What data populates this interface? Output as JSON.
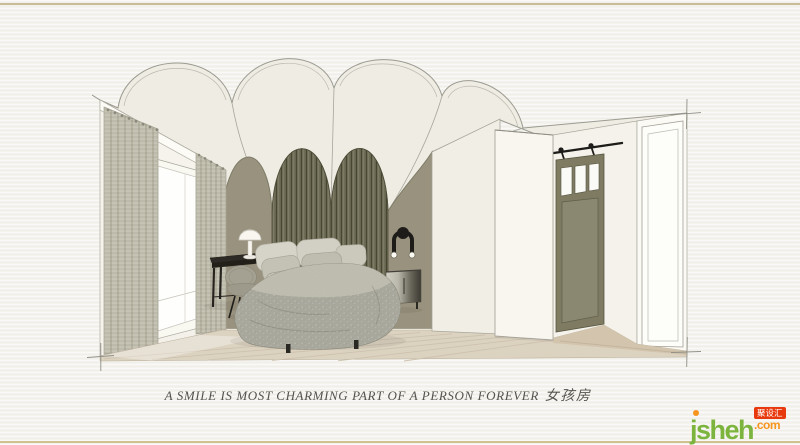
{
  "caption": {
    "text_en": "A SMILE IS MOST CHARMING PART OF A PERSON FOREVER",
    "text_zh": "女孩房"
  },
  "watermark": {
    "site": "jsheh.com",
    "brand": "jsheh",
    "tld": ".com",
    "badge_text": "聚设汇"
  },
  "palette": {
    "paper": "#f3f2ed",
    "border_gold": "#c9bd97",
    "ceiling_cream": "#efece3",
    "line_gray": "#9b9b91",
    "wall_olive": "#99927e",
    "slat_olive": "#6f6d57",
    "slat_shadow": "#474631",
    "wall_white": "#f5f3eb",
    "partition_white": "#f1efe5",
    "wardrobe_white": "#f8f6ef",
    "floor_tan": "#dcd2c0",
    "corridor_floor": "#d3c5ad",
    "curtain_weave": "#c9c6b7",
    "door_olive": "#7e7b62",
    "hardware_black": "#1d1c19",
    "furniture_black": "#2e2b26",
    "bedding_gray": "#a9a89d",
    "bedding_light": "#d6d4c9",
    "caption_ink": "#54534e",
    "logo_green": "#7cb43e",
    "logo_orange": "#f7941d",
    "logo_red": "#e8380d"
  }
}
